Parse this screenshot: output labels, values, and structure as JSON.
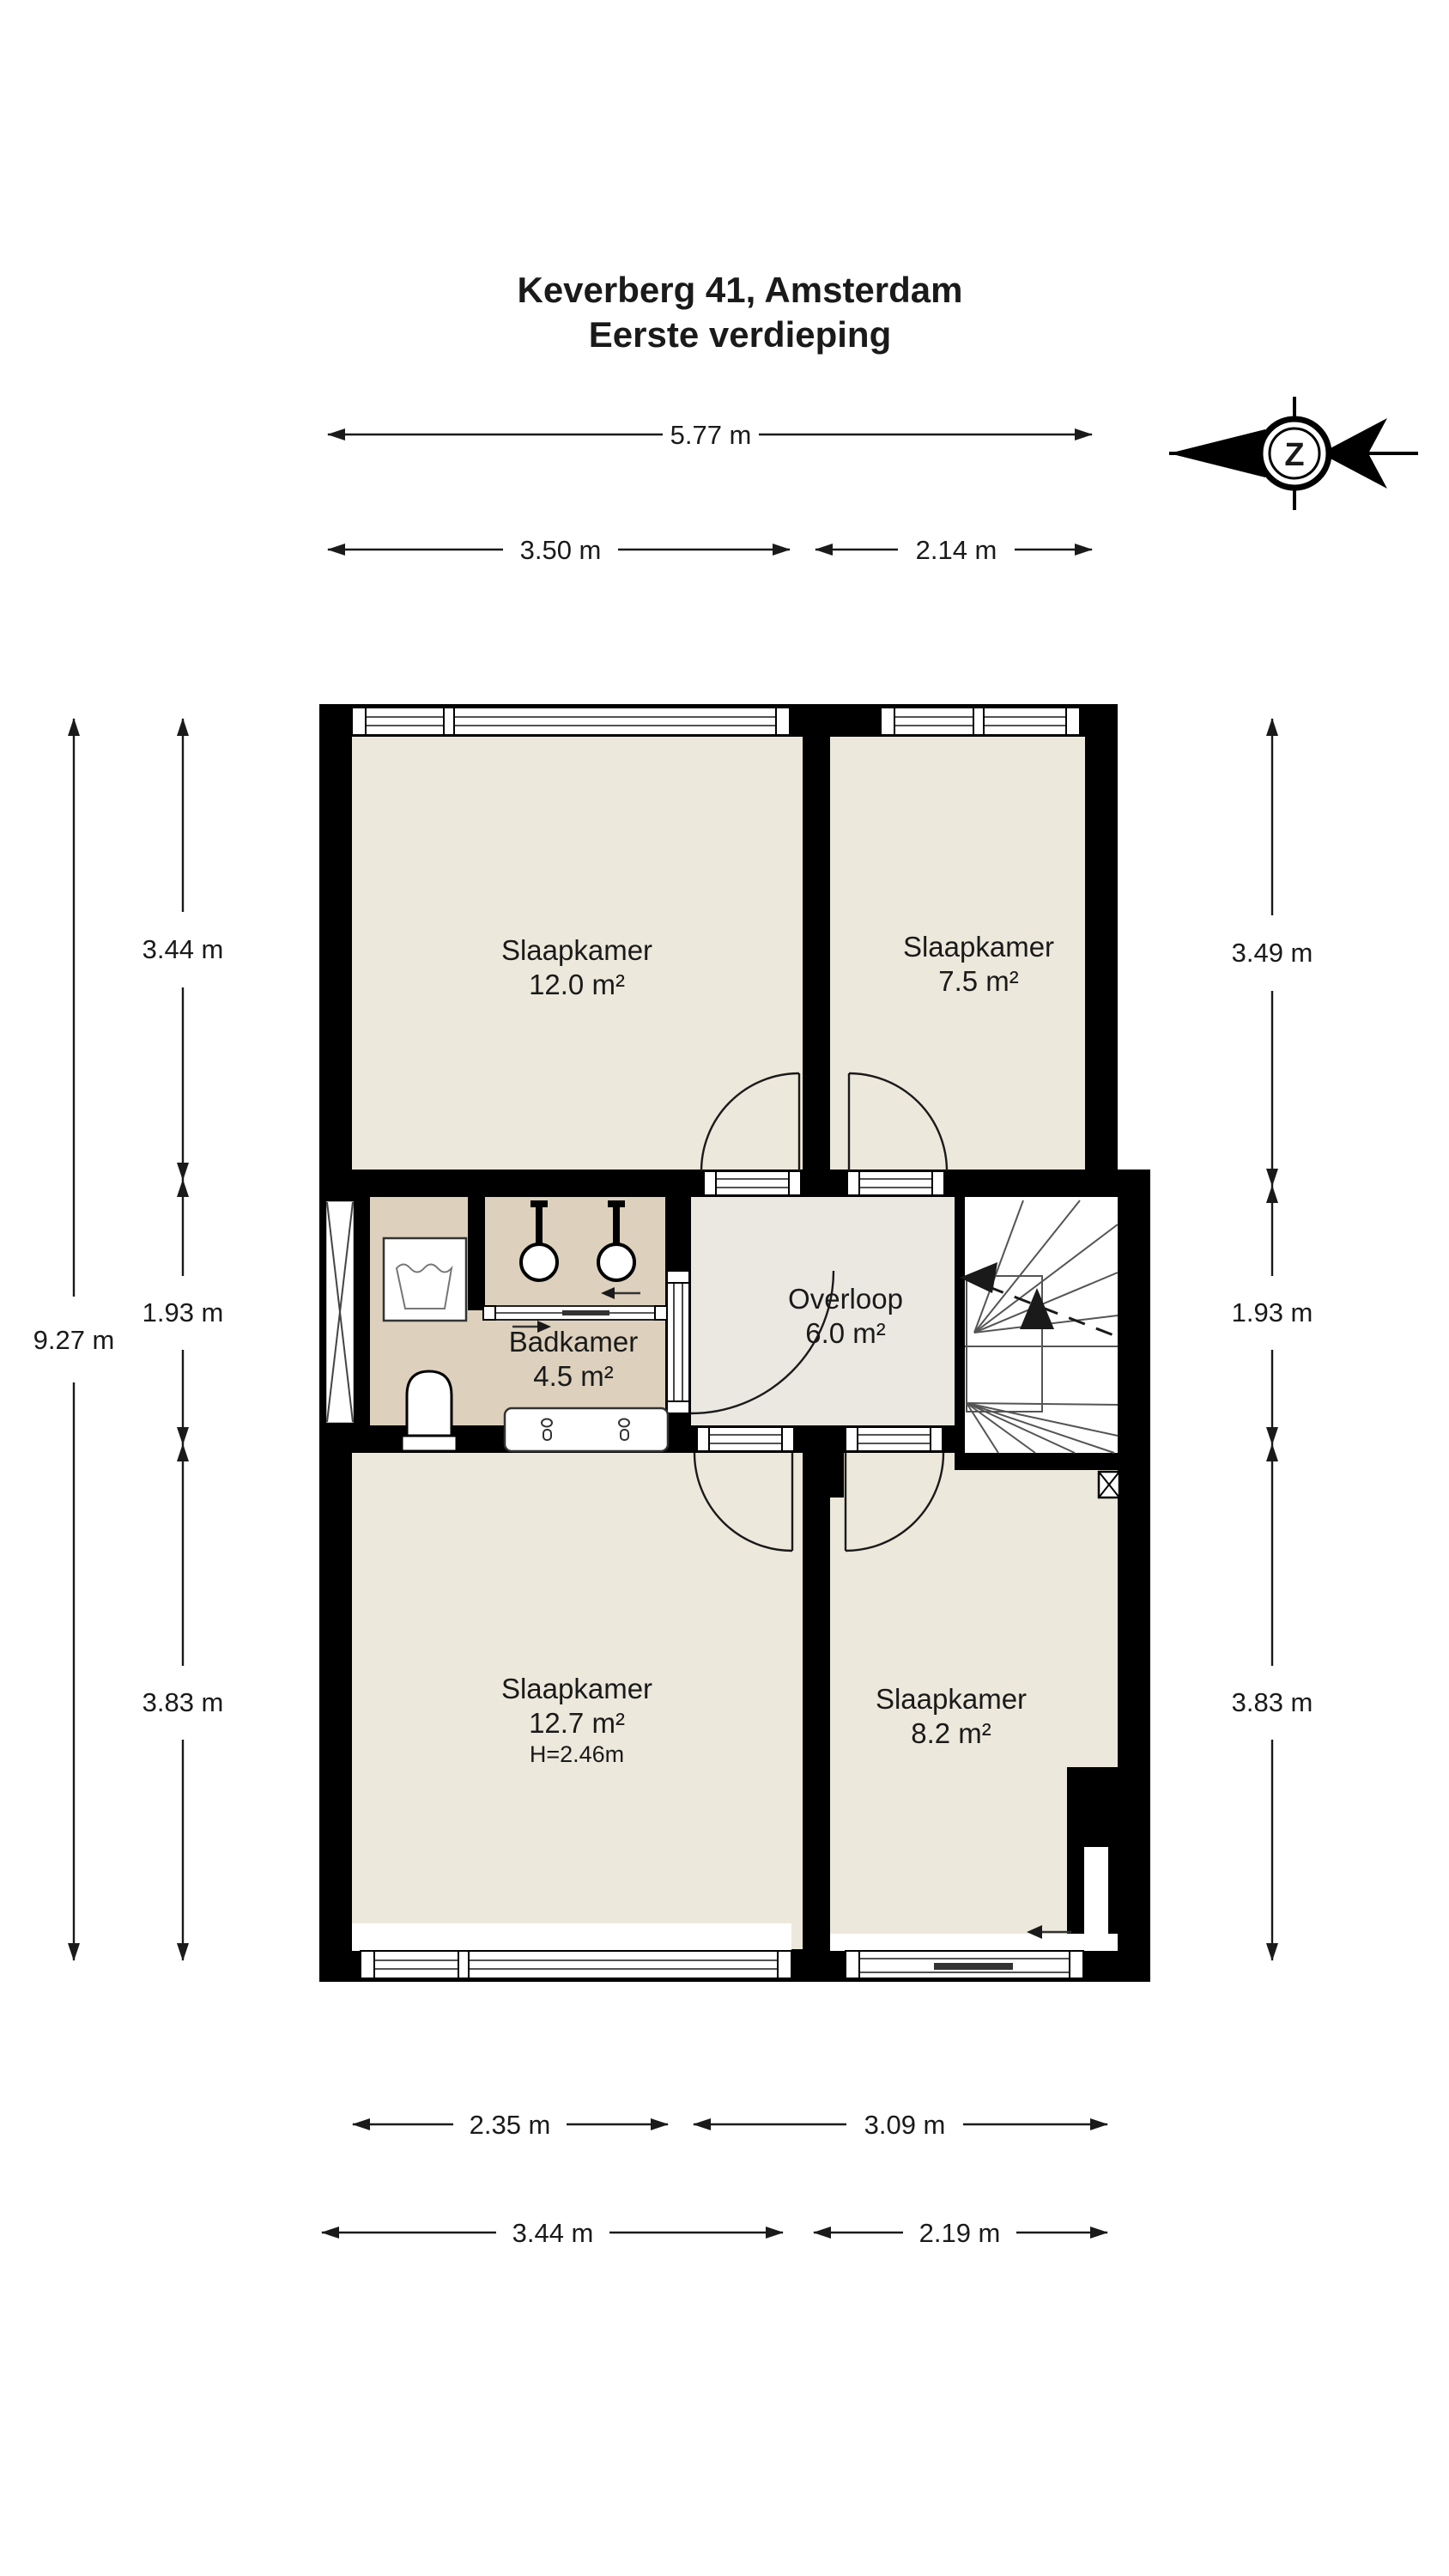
{
  "title": {
    "line1": "Keverberg 41, Amsterdam",
    "line2": "Eerste verdieping"
  },
  "compass": {
    "letter": "Z"
  },
  "rooms": {
    "slaapkamer_tl": {
      "name": "Slaapkamer",
      "area": "12.0 m²"
    },
    "slaapkamer_tr": {
      "name": "Slaapkamer",
      "area": "7.5 m²"
    },
    "badkamer": {
      "name": "Badkamer",
      "area": "4.5 m²"
    },
    "overloop": {
      "name": "Overloop",
      "area": "6.0 m²"
    },
    "slaapkamer_bl": {
      "name": "Slaapkamer",
      "area": "12.7 m²",
      "ceiling": "H=2.46m"
    },
    "slaapkamer_br": {
      "name": "Slaapkamer",
      "area": "8.2 m²"
    }
  },
  "dimensions": {
    "top_total": "5.77 m",
    "top_left": "3.50 m",
    "top_right": "2.14 m",
    "left_total": "9.27 m",
    "left_top": "3.44 m",
    "left_mid": "1.93 m",
    "left_bottom": "3.83 m",
    "right_top": "3.49 m",
    "right_mid": "1.93 m",
    "right_bottom": "3.83 m",
    "bottom_inner_left": "2.35 m",
    "bottom_inner_right": "3.09 m",
    "bottom_outer_left": "3.44 m",
    "bottom_outer_right": "2.19 m"
  },
  "colors": {
    "wall": "#000000",
    "room_fill": "#ECE8DB",
    "bathroom_fill": "#DDD1BD",
    "hall_fill": "#EAE8E1",
    "stair_fill": "#FFFFFF"
  }
}
